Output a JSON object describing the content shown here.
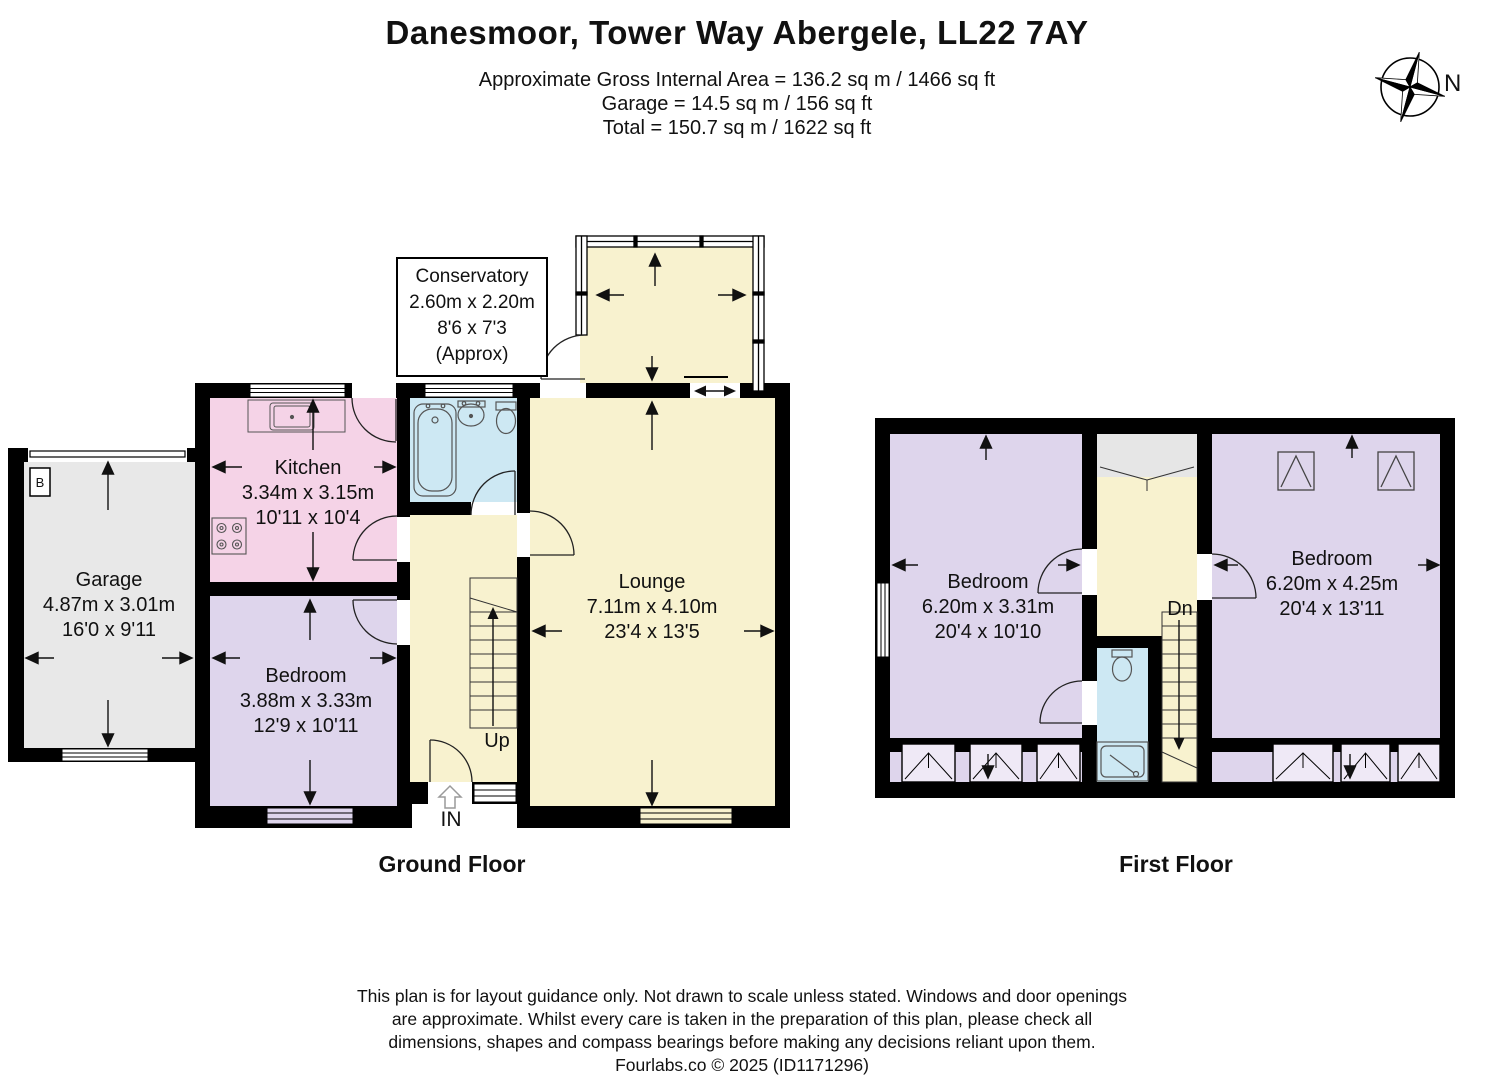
{
  "header": {
    "title": "Danesmoor, Tower Way Abergele, LL22 7AY",
    "area_line_1": "Approximate Gross Internal Area = 136.2 sq m / 1466 sq ft",
    "area_line_2": "Garage = 14.5 sq m / 156 sq ft",
    "area_line_3": "Total = 150.7 sq m / 1622 sq ft"
  },
  "compass": {
    "north_label": "N"
  },
  "ground_floor": {
    "floor_label": "Ground Floor",
    "conservatory": {
      "name": "Conservatory",
      "metric": "2.60m x 2.20m",
      "imperial": "8'6 x 7'3",
      "note": "(Approx)"
    },
    "kitchen": {
      "name": "Kitchen",
      "metric": "3.34m x 3.15m",
      "imperial": "10'11 x 10'4"
    },
    "garage": {
      "name": "Garage",
      "metric": "4.87m x 3.01m",
      "imperial": "16'0 x 9'11"
    },
    "bedroom": {
      "name": "Bedroom",
      "metric": "3.88m x 3.33m",
      "imperial": "12'9 x 10'11"
    },
    "lounge": {
      "name": "Lounge",
      "metric": "7.11m x 4.10m",
      "imperial": "23'4 x 13'5"
    },
    "stairs_label": "Up",
    "entrance_label": "IN",
    "boiler_label": "B"
  },
  "first_floor": {
    "floor_label": "First Floor",
    "bedroom_left": {
      "name": "Bedroom",
      "metric": "6.20m x 3.31m",
      "imperial": "20'4 x 10'10"
    },
    "bedroom_right": {
      "name": "Bedroom",
      "metric": "6.20m x 4.25m",
      "imperial": "20'4 x 13'11"
    },
    "stairs_label": "Dn"
  },
  "footer": {
    "line_1": "This plan is for layout guidance only. Not drawn to scale unless stated. Windows and door openings",
    "line_2": "are approximate. Whilst every care is taken in the preparation of this plan, please check all",
    "line_3": "dimensions, shapes and compass bearings before making any decisions reliant upon them.",
    "line_4": "Fourlabs.co © 2025 (ID1171296)"
  },
  "colors": {
    "room_yellow": "#f8f2cf",
    "kitchen_pink": "#f5d3e7",
    "bedroom_lilac": "#ded5ec",
    "bathroom_blue": "#cde8f3",
    "garage_gray": "#e8e8e8",
    "wall_black": "#000000"
  }
}
